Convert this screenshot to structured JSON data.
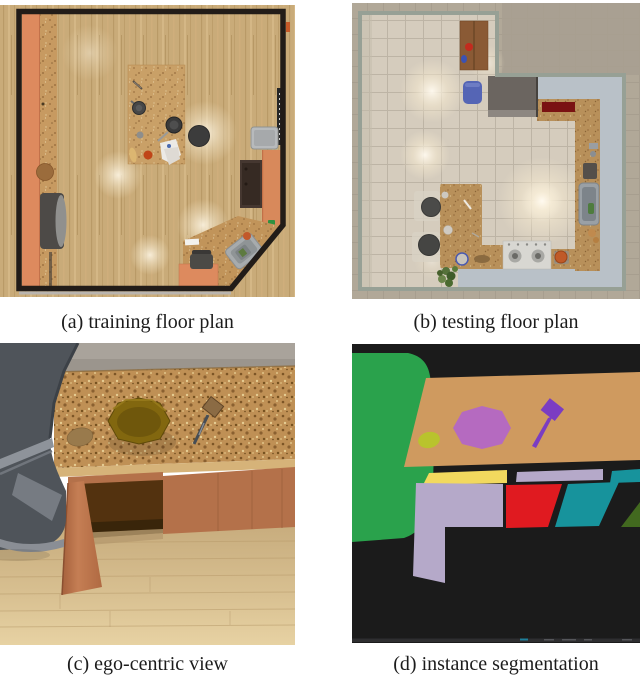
{
  "figure": {
    "panels": [
      {
        "id": "a",
        "caption": "(a) training floor plan"
      },
      {
        "id": "b",
        "caption": "(b) testing floor plan"
      },
      {
        "id": "c",
        "caption": "(c) ego-centric view"
      },
      {
        "id": "d",
        "caption": "(d) instance segmentation"
      }
    ]
  },
  "segmentation_palette": {
    "background": "#1b1b1b",
    "chair": "#2aa24c",
    "table_top": "#cf9a5f",
    "pot": "#b56ac0",
    "potato": "#b9c32d",
    "spatula": "#7b3dc2",
    "drawer_yellow": "#f2d95e",
    "door_lavender": "#b5a9c9",
    "panel_red": "#e01a20",
    "panel_teal": "#17939c",
    "panel_darkgreen": "#42691f",
    "footer_strip": "#2e2e30",
    "footer_speck_teal": "#1f7f9a",
    "footer_speck_gray": "#55565a"
  }
}
